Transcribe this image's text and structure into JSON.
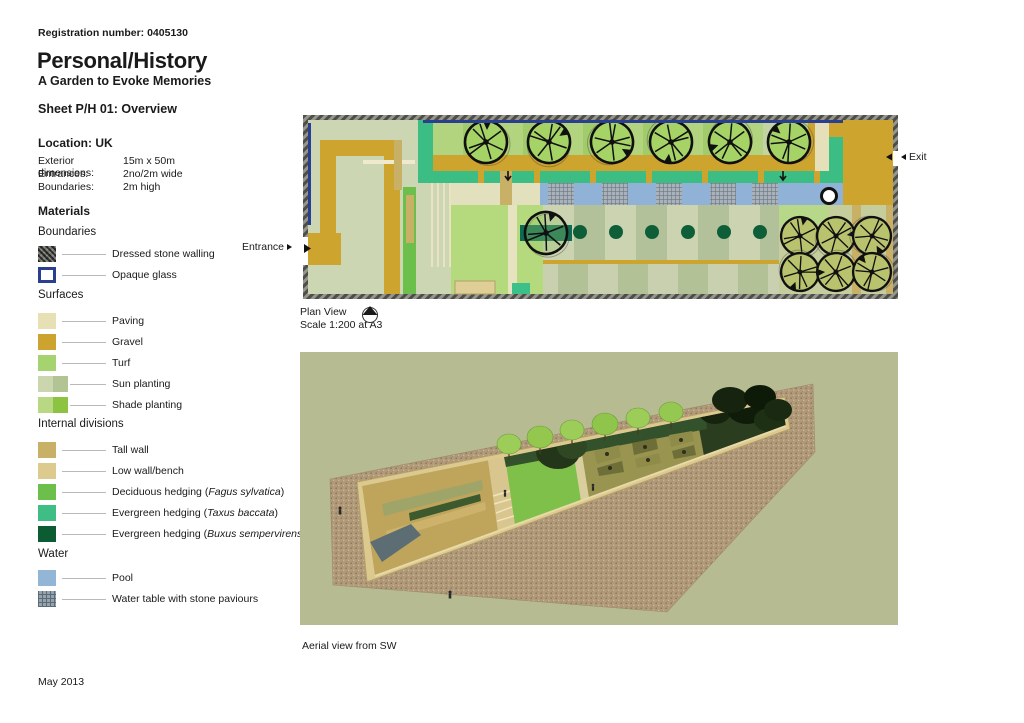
{
  "header": {
    "registration": "Registration number: 0405130",
    "title": "Personal/History",
    "subtitle": "A Garden to Evoke Memories",
    "sheet": "Sheet P/H 01: Overview",
    "location": "Location: UK"
  },
  "specs": {
    "rows": [
      {
        "label": "Exterior dimensions:",
        "value": "15m x 50m"
      },
      {
        "label": "Entrances:",
        "value": "2no/2m wide"
      },
      {
        "label": "Boundaries:",
        "value": "2m high"
      }
    ]
  },
  "materials": {
    "title": "Materials",
    "sections": [
      {
        "heading": "Boundaries",
        "items": [
          {
            "prefix": "Dressed stone walling",
            "swatch": "dressed-stone"
          },
          {
            "prefix": "Opaque glass",
            "swatch": "opaque-glass"
          }
        ]
      },
      {
        "heading": "Surfaces",
        "items": [
          {
            "prefix": "Paving",
            "swatch": "paving"
          },
          {
            "prefix": "Gravel",
            "swatch": "gravel"
          },
          {
            "prefix": "Turf",
            "swatch": "turf"
          },
          {
            "prefix": "Sun planting",
            "swatch": "sun-planting"
          },
          {
            "prefix": "Shade planting",
            "swatch": "shade-planting"
          }
        ]
      },
      {
        "heading": "Internal divisions",
        "items": [
          {
            "prefix": "Tall wall",
            "swatch": "tall-wall"
          },
          {
            "prefix": "Low wall/bench",
            "swatch": "low-wall"
          },
          {
            "prefix": "Deciduous hedging (",
            "species": "Fagus sylvatica",
            "suffix": ")",
            "swatch": "deciduous-hedge"
          },
          {
            "prefix": "Evergreen hedging (",
            "species": "Taxus baccata",
            "suffix": ")",
            "swatch": "taxus-hedge"
          },
          {
            "prefix": "Evergreen hedging (",
            "species": "Buxus sempervirens",
            "suffix": ")",
            "swatch": "buxus-hedge"
          }
        ]
      },
      {
        "heading": "Water",
        "items": [
          {
            "prefix": "Pool",
            "swatch": "pool"
          },
          {
            "prefix": "Water table with stone paviours",
            "swatch": "water-table"
          }
        ]
      }
    ]
  },
  "plan": {
    "caption_line1": "Plan View",
    "caption_line2": "Scale 1:200 at A3",
    "entrance_label": "Entrance",
    "exit_label": "Exit"
  },
  "aerial": {
    "caption": "Aerial view from SW"
  },
  "footer": {
    "date": "May 2013"
  },
  "colors": {
    "glass_blue": "#2b3f90",
    "paving": "#e7e0b5",
    "gravel": "#cda32f",
    "turf": "#a5d36f",
    "sun_planting": "#ccd6ae",
    "shade_planting": "#8cc441",
    "tall_wall": "#c8b166",
    "low_wall": "#ddca8f",
    "deciduous_hedge": "#6cbf4a",
    "taxus_hedge": "#3ebd85",
    "buxus_hedge": "#0b5c33",
    "pool_blue": "#93b5d6",
    "water_table": "#95a3af",
    "stone_wall": "#6f6f68"
  }
}
